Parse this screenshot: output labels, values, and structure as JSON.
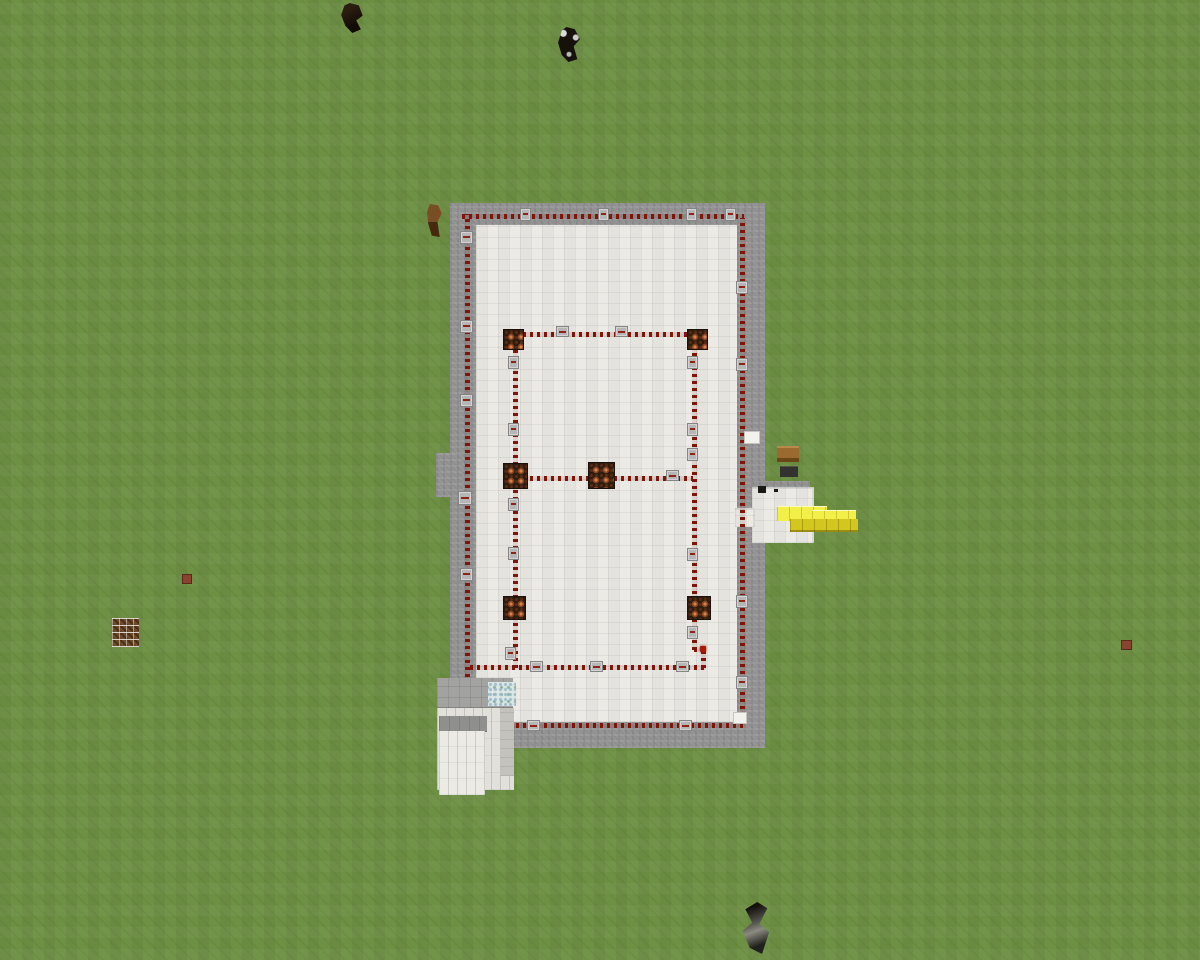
{
  "meta": {
    "app": "Minecraft",
    "view": "top-down aerial screenshot of a redstone-lamp platform build on a flat grass plain"
  },
  "palette": {
    "grass": "#6e9044",
    "stone_border": "#949494",
    "quartz_floor": "#eceae4",
    "redstone_dust": "#7e150a",
    "repeater_block": "#b6b6b6",
    "lamp_base": "#2c1c10",
    "lamp_glow": "#d2854a",
    "gold_top": "#f2ef48",
    "gold_side": "#d3c61f",
    "white_block": "#f3f1eb"
  },
  "scene": {
    "items": [
      {
        "t": "stone-border",
        "n": "stone-platform-border",
        "x": 450,
        "y": 203,
        "w": 315,
        "h": 545
      },
      {
        "t": "stone-border",
        "n": "stone-notch-west",
        "x": 436,
        "y": 453,
        "w": 26,
        "h": 44
      },
      {
        "t": "quartz-floor",
        "n": "quartz-floor",
        "x": 476,
        "y": 225,
        "w": 261,
        "h": 497
      },
      {
        "t": "stone-strip",
        "n": "stone-strip-east",
        "x": 752,
        "y": 481,
        "w": 58,
        "h": 7
      },
      {
        "t": "white-ext",
        "n": "quartz-extension-east",
        "x": 752,
        "y": 487,
        "w": 62,
        "h": 56
      },
      {
        "t": "white-ext",
        "n": "quartz-extension-gap",
        "x": 735,
        "y": 508,
        "w": 20,
        "h": 19
      },
      {
        "t": "dark-item",
        "n": "lever-pair",
        "x": 758,
        "y": 486,
        "w": 8,
        "h": 7
      },
      {
        "t": "dust-h",
        "n": "redstone-loop-top",
        "x": 462,
        "y": 214,
        "w": 282,
        "h": 5
      },
      {
        "t": "dust-v",
        "n": "redstone-loop-left",
        "x": 465,
        "y": 214,
        "w": 5,
        "h": 512
      },
      {
        "t": "dust-v",
        "n": "redstone-loop-right",
        "x": 740,
        "y": 218,
        "w": 5,
        "h": 505
      },
      {
        "t": "dust-h",
        "n": "redstone-loop-bottom",
        "x": 467,
        "y": 723,
        "w": 278,
        "h": 5
      },
      {
        "t": "dust-v",
        "n": "redstone-wire-inner-left",
        "x": 513,
        "y": 348,
        "w": 5,
        "h": 320
      },
      {
        "t": "dust-v",
        "n": "redstone-wire-inner-right",
        "x": 692,
        "y": 348,
        "w": 5,
        "h": 302
      },
      {
        "t": "dust-h",
        "n": "redstone-wire-row-top",
        "x": 523,
        "y": 332,
        "w": 166,
        "h": 5
      },
      {
        "t": "dust-h",
        "n": "redstone-wire-row-middle",
        "x": 523,
        "y": 476,
        "w": 170,
        "h": 5
      },
      {
        "t": "dust-h",
        "n": "redstone-wire-row-bottom",
        "x": 470,
        "y": 665,
        "w": 236,
        "h": 5
      },
      {
        "t": "dust-h",
        "n": "redstone-wire-jog",
        "x": 694,
        "y": 648,
        "w": 11,
        "h": 4
      },
      {
        "t": "dust-v",
        "n": "redstone-wire-jog-down",
        "x": 701,
        "y": 648,
        "w": 5,
        "h": 20
      },
      {
        "t": "red-dot",
        "n": "redstone-torch",
        "x": 700,
        "y": 646,
        "w": 6,
        "h": 6
      },
      {
        "t": "repeater",
        "x": 520,
        "y": 208,
        "w": 11,
        "h": 13
      },
      {
        "t": "repeater",
        "x": 598,
        "y": 208,
        "w": 11,
        "h": 13
      },
      {
        "t": "repeater",
        "x": 686,
        "y": 208,
        "w": 11,
        "h": 13
      },
      {
        "t": "repeater",
        "x": 725,
        "y": 208,
        "w": 11,
        "h": 13
      },
      {
        "t": "repeater",
        "x": 460,
        "y": 231,
        "w": 13,
        "h": 13
      },
      {
        "t": "repeater",
        "x": 460,
        "y": 320,
        "w": 13,
        "h": 13
      },
      {
        "t": "repeater",
        "x": 460,
        "y": 394,
        "w": 13,
        "h": 13
      },
      {
        "t": "repeater",
        "x": 458,
        "y": 491,
        "w": 14,
        "h": 14
      },
      {
        "t": "repeater",
        "x": 460,
        "y": 568,
        "w": 13,
        "h": 13
      },
      {
        "t": "repeater",
        "x": 736,
        "y": 281,
        "w": 12,
        "h": 13
      },
      {
        "t": "repeater",
        "x": 736,
        "y": 358,
        "w": 12,
        "h": 13
      },
      {
        "t": "repeater",
        "x": 736,
        "y": 595,
        "w": 12,
        "h": 13
      },
      {
        "t": "repeater",
        "x": 736,
        "y": 676,
        "w": 12,
        "h": 13
      },
      {
        "t": "white-block",
        "x": 744,
        "y": 431,
        "w": 16,
        "h": 13
      },
      {
        "t": "white-block",
        "x": 733,
        "y": 712,
        "w": 14,
        "h": 12
      },
      {
        "t": "repeater",
        "x": 508,
        "y": 356,
        "w": 11,
        "h": 13
      },
      {
        "t": "repeater",
        "x": 508,
        "y": 423,
        "w": 11,
        "h": 13
      },
      {
        "t": "repeater",
        "x": 508,
        "y": 498,
        "w": 11,
        "h": 13
      },
      {
        "t": "repeater",
        "x": 508,
        "y": 547,
        "w": 11,
        "h": 13
      },
      {
        "t": "repeater",
        "x": 505,
        "y": 647,
        "w": 11,
        "h": 13
      },
      {
        "t": "repeater",
        "x": 687,
        "y": 356,
        "w": 11,
        "h": 13
      },
      {
        "t": "repeater",
        "x": 687,
        "y": 423,
        "w": 11,
        "h": 13
      },
      {
        "t": "repeater",
        "x": 687,
        "y": 448,
        "w": 11,
        "h": 13
      },
      {
        "t": "repeater",
        "x": 687,
        "y": 548,
        "w": 11,
        "h": 13
      },
      {
        "t": "repeater",
        "x": 687,
        "y": 626,
        "w": 11,
        "h": 13
      },
      {
        "t": "repeater",
        "x": 556,
        "y": 326,
        "w": 13,
        "h": 11
      },
      {
        "t": "repeater",
        "x": 615,
        "y": 326,
        "w": 13,
        "h": 11
      },
      {
        "t": "repeater",
        "x": 666,
        "y": 470,
        "w": 13,
        "h": 11
      },
      {
        "t": "repeater",
        "x": 530,
        "y": 661,
        "w": 13,
        "h": 11
      },
      {
        "t": "repeater",
        "x": 590,
        "y": 661,
        "w": 13,
        "h": 11
      },
      {
        "t": "repeater",
        "x": 676,
        "y": 661,
        "w": 13,
        "h": 11
      },
      {
        "t": "repeater",
        "x": 527,
        "y": 720,
        "w": 13,
        "h": 11
      },
      {
        "t": "repeater",
        "x": 679,
        "y": 720,
        "w": 13,
        "h": 11
      },
      {
        "t": "lamp",
        "n": "redstone-lamp-nw",
        "x": 503,
        "y": 329,
        "w": 21,
        "h": 21
      },
      {
        "t": "lamp",
        "n": "redstone-lamp-ne",
        "x": 687,
        "y": 329,
        "w": 21,
        "h": 21
      },
      {
        "t": "lamp",
        "n": "redstone-lamp-mid-west",
        "x": 503,
        "y": 463,
        "w": 25,
        "h": 26
      },
      {
        "t": "lamp",
        "n": "redstone-lamp-mid-center",
        "x": 588,
        "y": 462,
        "w": 27,
        "h": 27
      },
      {
        "t": "lamp",
        "n": "redstone-lamp-sw",
        "x": 503,
        "y": 596,
        "w": 23,
        "h": 24
      },
      {
        "t": "lamp",
        "n": "redstone-lamp-se",
        "x": 687,
        "y": 596,
        "w": 24,
        "h": 24
      },
      {
        "t": "gold-top",
        "n": "gold-arm-top",
        "x": 777,
        "y": 506,
        "w": 50,
        "h": 15
      },
      {
        "t": "gold-top",
        "n": "gold-arm-top",
        "x": 812,
        "y": 510,
        "w": 44,
        "h": 13
      },
      {
        "t": "gold-side",
        "n": "gold-arm-side",
        "x": 790,
        "y": 519,
        "w": 68,
        "h": 13
      },
      {
        "t": "tower-top",
        "n": "quartz-tower-roof",
        "x": 437,
        "y": 678,
        "w": 76,
        "h": 31
      },
      {
        "t": "tower-front",
        "n": "quartz-tower-face",
        "x": 437,
        "y": 708,
        "w": 77,
        "h": 82
      },
      {
        "t": "tower-side",
        "n": "quartz-tower-side",
        "x": 500,
        "y": 708,
        "w": 14,
        "h": 68
      },
      {
        "t": "tower-step-top",
        "n": "quartz-step-roof",
        "x": 439,
        "y": 716,
        "w": 48,
        "h": 16
      },
      {
        "t": "tower-step-front",
        "n": "quartz-step-face",
        "x": 439,
        "y": 731,
        "w": 46,
        "h": 64
      },
      {
        "t": "ice-patch",
        "n": "frosted-patch",
        "x": 488,
        "y": 682,
        "w": 28,
        "h": 24
      },
      {
        "t": "wood-block",
        "n": "wood-block",
        "x": 777,
        "y": 446,
        "w": 22,
        "h": 16
      },
      {
        "t": "anvil-block",
        "n": "anvil-block",
        "x": 780,
        "y": 466,
        "w": 18,
        "h": 11
      },
      {
        "t": "mob-dark",
        "n": "dark-mob-north",
        "x": 338,
        "y": 3,
        "w": 26,
        "h": 30
      },
      {
        "t": "mob-bw",
        "n": "black-white-mob",
        "x": 556,
        "y": 27,
        "w": 26,
        "h": 35
      },
      {
        "t": "horse-brown",
        "n": "brown-horse",
        "x": 427,
        "y": 204,
        "w": 15,
        "h": 33
      },
      {
        "t": "mob-gray",
        "n": "gray-mob-south",
        "x": 733,
        "y": 902,
        "w": 44,
        "h": 52
      },
      {
        "t": "item-red",
        "n": "dropped-item",
        "x": 182,
        "y": 574,
        "w": 10,
        "h": 10
      },
      {
        "t": "item-red",
        "n": "dropped-item",
        "x": 1121,
        "y": 640,
        "w": 11,
        "h": 10
      },
      {
        "t": "frames-cluster",
        "n": "item-frames-cluster",
        "x": 112,
        "y": 618,
        "w": 27,
        "h": 29
      }
    ]
  }
}
